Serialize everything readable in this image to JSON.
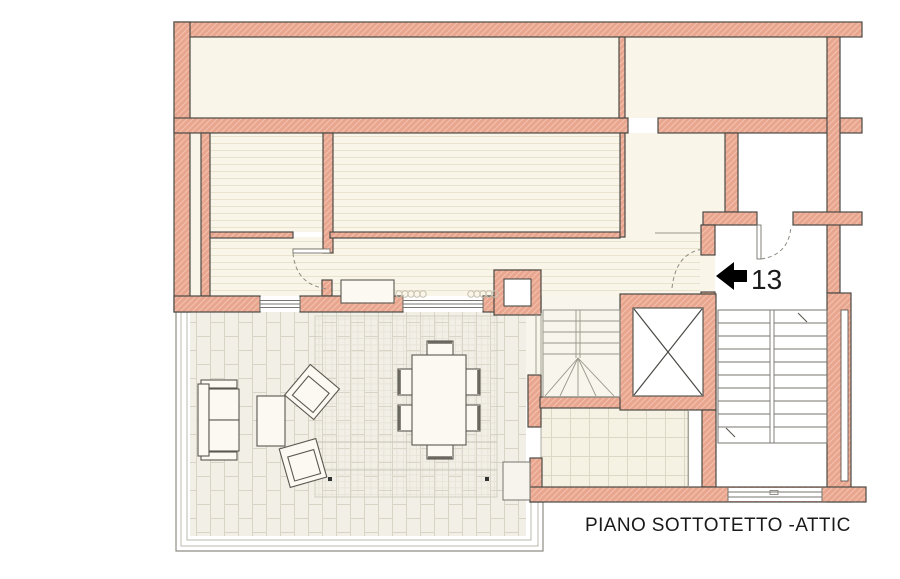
{
  "plan": {
    "unit_number": "13",
    "caption": "PIANO SOTTOTETTO -ATTIC"
  },
  "colors": {
    "wall_fill": "#e9a68f",
    "wall_hatch": "#f3c2af",
    "wall_outline": "#4b4a45",
    "room_cream": "#f9f5e8",
    "room_hatch_line": "#e9e2cd",
    "terrace_fill": "#f1efe6",
    "tile_line": "#d8d4c6",
    "bath_fill": "#f6f2e3",
    "bath_tile_line": "#ddd8c6",
    "line_gray": "#77756d",
    "furniture_stroke": "#5a584f",
    "text": "#1a1a1a"
  },
  "symbols": {
    "entrance_marker": "left-arrow",
    "elevator": "x-cross-shaft",
    "main_stair": "double-flight-staircase",
    "inner_stair": "winder-staircase",
    "doors": "dashed-swing-arc",
    "heaters": "radiator-coil"
  }
}
